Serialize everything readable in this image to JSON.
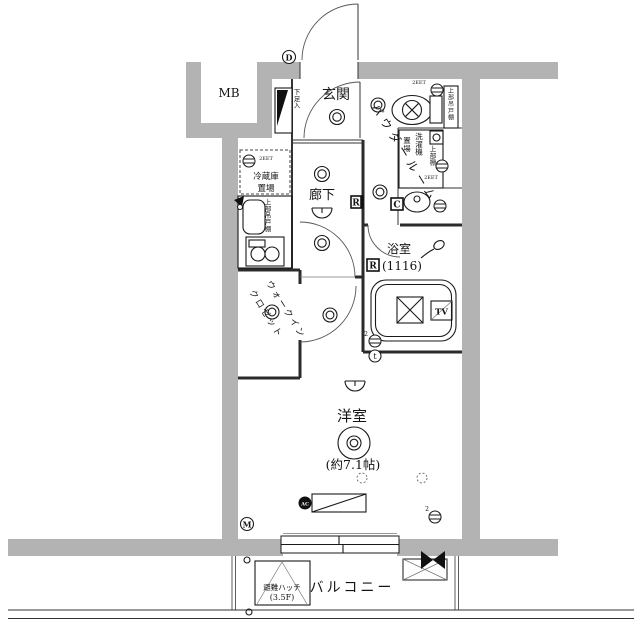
{
  "rooms": {
    "mb": "MB",
    "genkan": "玄関",
    "hallway": "廊下",
    "powder_room": "パウダールーム",
    "bathroom": "浴室",
    "bathroom_size": "(1116)",
    "wic_line1": "ウォークイン",
    "wic_line2": "クロゼット",
    "bedroom": "洋室",
    "bedroom_size": "(約7.1帖)",
    "balcony": "バルコニー"
  },
  "fixtures": {
    "shoe_cabinet": "下足入",
    "fridge_space_line1": "冷蔵庫",
    "fridge_space_line2": "置場",
    "kitchen_upper_cabinet": "上部吊戸棚",
    "toilet_upper_cabinet": "上部吊戸棚",
    "washer_space_line1": "洗濯機",
    "washer_space_line2": "置場",
    "washer_upper_shelf": "上部棚",
    "hatch_line1": "避難ハッチ",
    "hatch_line2": "(3.5F)"
  },
  "badges": {
    "door": "D",
    "meter": "M",
    "hall_remote": "R",
    "bath_remote": "R",
    "controller": "C",
    "thermo": "t",
    "tv": "TV",
    "ac": "AC"
  },
  "tags": {
    "fridge_outlet": "2EET",
    "toilet_outlet": "2EET",
    "washer_outlet": "2EET",
    "bath_outlet": "2",
    "room_outlet": "2"
  },
  "icons": [
    "toilet-icon",
    "bathtub-icon",
    "washbasin-icon",
    "shower-icon",
    "sink-icon",
    "stove-icon",
    "ceiling-light-icon",
    "downlight-icon",
    "wall-light-icon",
    "outlet-icon",
    "door-swing-icon",
    "sliding-window-icon",
    "ac-unit-icon",
    "evacuation-hatch-icon",
    "balcony-partition-icon",
    "shoe-cabinet-icon"
  ],
  "colors": {
    "wall_fill": "#b3b3b3",
    "line": "#1a1a1a",
    "background": "#ffffff"
  }
}
